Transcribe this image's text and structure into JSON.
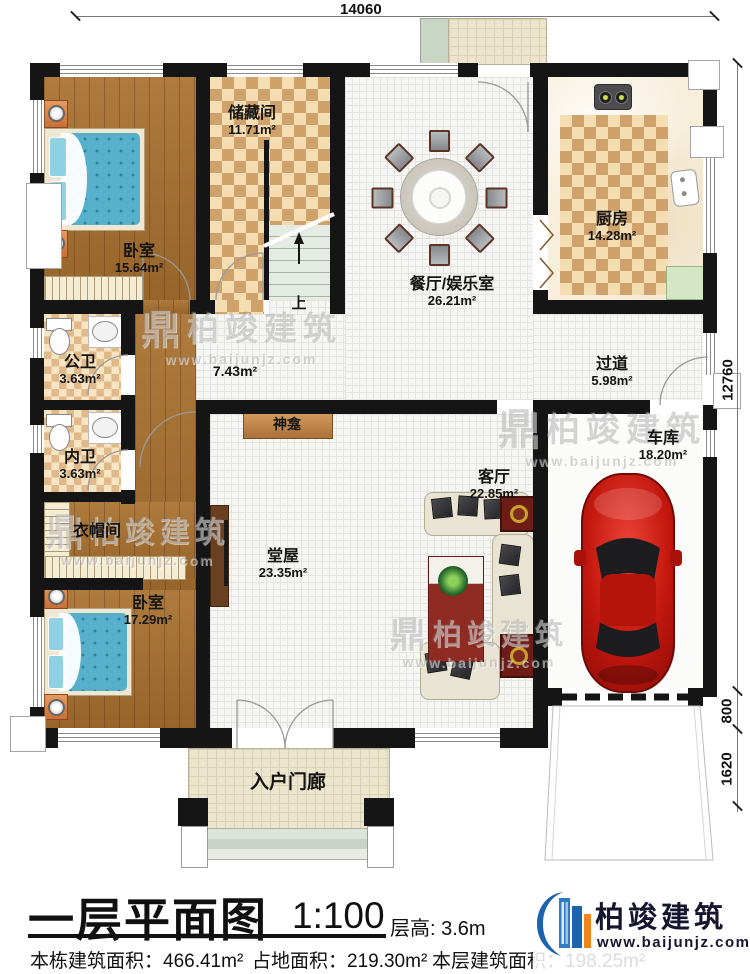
{
  "dims": {
    "top_width": "14060",
    "right_main": "12760",
    "right_mid": "800",
    "right_low": "1620"
  },
  "rooms": {
    "storage": {
      "name": "储藏间",
      "area": "11.71m²"
    },
    "bedroom_tl": {
      "name": "卧室",
      "area": "15.64m²"
    },
    "dining": {
      "name": "餐厅/娱乐室",
      "area": "26.21m²"
    },
    "kitchen": {
      "name": "厨房",
      "area": "14.28m²"
    },
    "public_bath": {
      "name": "公卫",
      "area": "3.63m²"
    },
    "inner_bath": {
      "name": "内卫",
      "area": "3.63m²"
    },
    "cloakroom": {
      "name": "衣帽间"
    },
    "bedroom_bl": {
      "name": "卧室",
      "area": "17.29m²"
    },
    "corridor": {
      "area": "7.43m²"
    },
    "hallway": {
      "name": "过道",
      "area": "5.98m²"
    },
    "shrine": {
      "name": "神龛"
    },
    "main_hall": {
      "name": "堂屋",
      "area": "23.35m²"
    },
    "living": {
      "name": "客厅",
      "area": "22.85m²"
    },
    "garage": {
      "name": "车库",
      "area": "18.20m²"
    },
    "porch": {
      "name": "入户门廊"
    },
    "stairs_up": {
      "name": "上"
    }
  },
  "footer": {
    "title": "一层平面图",
    "scale": "1:100",
    "floor_height": "层高: 3.6m",
    "total_area": "本栋建筑面积：466.41m²",
    "land_area": "占地面积：219.30m²",
    "floor_area": "本层建筑面积：198.25m²"
  },
  "brand": {
    "name": "柏竣建筑",
    "url": "www.baijunjz.com"
  },
  "watermark": {
    "glyph": "鼎"
  },
  "colors": {
    "logo_blue": "#1b63ad",
    "logo_orange": "#f08519",
    "car_red": "#c4180f",
    "watermark_gray": "#7d7d7d"
  }
}
